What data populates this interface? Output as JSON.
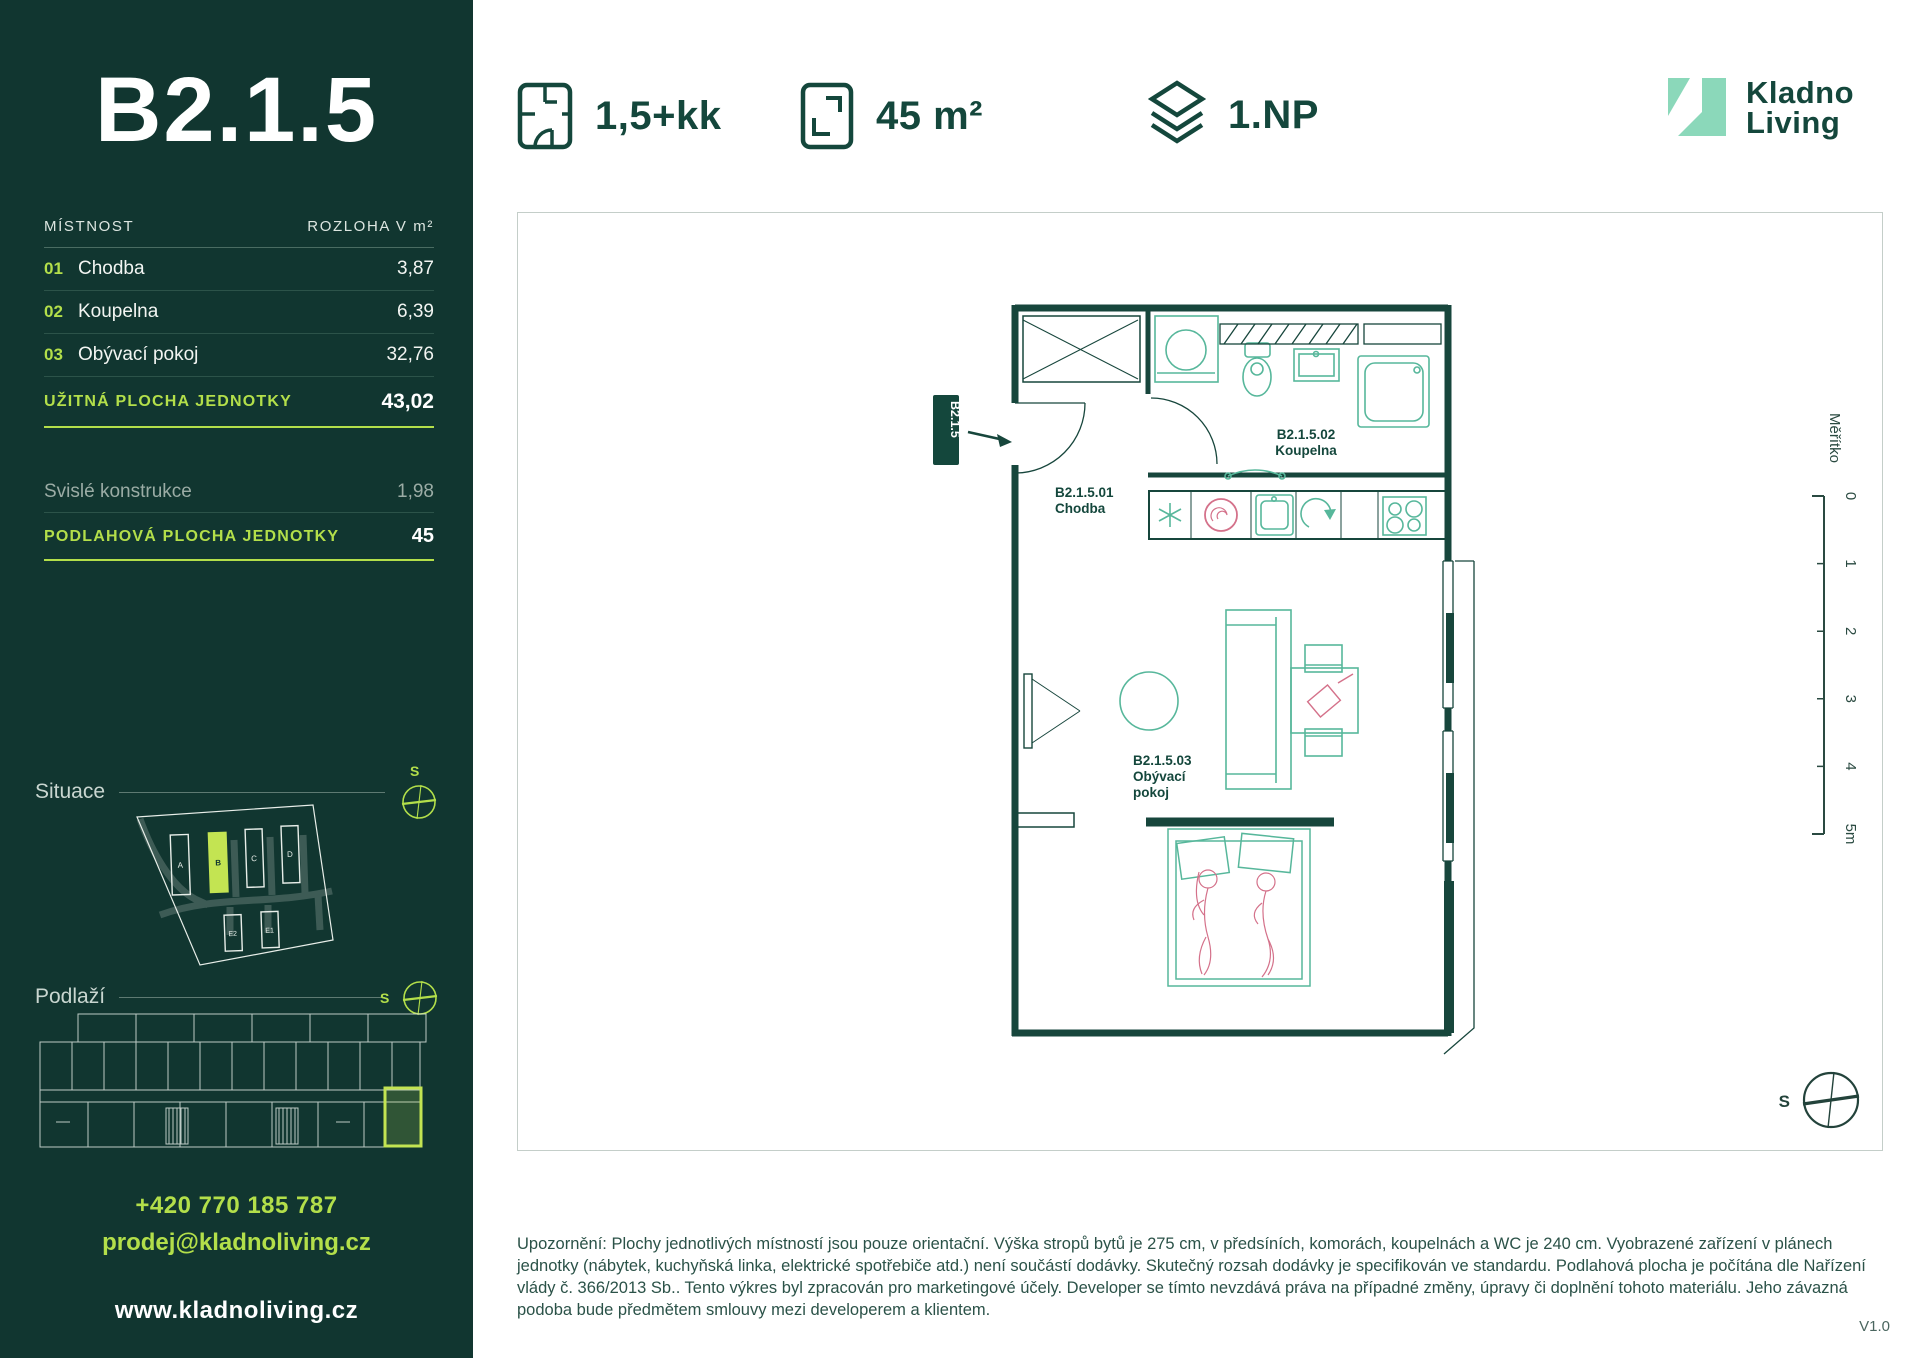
{
  "sidebar": {
    "unit_id": "B2.1.5",
    "table": {
      "header_room": "MÍSTNOST",
      "header_area": "ROZLOHA V m²",
      "rows": [
        {
          "num": "01",
          "name": "Chodba",
          "area": "3,87"
        },
        {
          "num": "02",
          "name": "Koupelna",
          "area": "6,39"
        },
        {
          "num": "03",
          "name": "Obývací pokoj",
          "area": "32,76"
        }
      ],
      "usable_label": "UŽITNÁ PLOCHA JEDNOTKY",
      "usable_value": "43,02",
      "construction_label": "Svislé konstrukce",
      "construction_value": "1,98",
      "floor_label": "PODLAHOVÁ PLOCHA JEDNOTKY",
      "floor_value": "45"
    },
    "situace_label": "Situace",
    "podlazi_label": "Podlaží",
    "compass_letter": "S",
    "site_buildings": [
      "A",
      "B",
      "C",
      "D",
      "E2",
      "E1"
    ],
    "highlighted_building": "B",
    "contact": {
      "phone": "+420 770 185 787",
      "email": "prodej@kladnoliving.cz",
      "web": "www.kladnoliving.cz"
    }
  },
  "header": {
    "specs": [
      {
        "label": "1,5+kk"
      },
      {
        "label": "45 m²"
      },
      {
        "label": "1.NP"
      }
    ],
    "logo_line1": "Kladno",
    "logo_line2": "Living"
  },
  "plan": {
    "entry_tag": "B2.1.5",
    "room1_id": "B2.1.5.01",
    "room1_name": "Chodba",
    "room2_id": "B2.1.5.02",
    "room2_name": "Koupelna",
    "room3_id": "B2.1.5.03",
    "room3_line1": "Obývací",
    "room3_line2": "pokoj",
    "scale_label": "Měřítko",
    "scale_ticks": [
      "0",
      "1",
      "2",
      "3",
      "4",
      "5m"
    ],
    "compass_letter": "S"
  },
  "footer": {
    "disclaimer": "Upozornění: Plochy jednotlivých místností jsou pouze orientační. Výška stropů bytů je 275 cm, v předsíních, komorách, koupelnách a WC je 240 cm. Vyobrazené zařízení v plánech jednotky (nábytek, kuchyňská linka, elektrické spotřebiče atd.) není součástí dodávky. Skutečný rozsah dodávky je specifikován ve standardu. Podlahová plocha je počítána dle Nařízení vlády č. 366/2013 Sb.. Tento výkres byl zpracován pro marketingové účely. Developer se tímto nevzdává práva na případné změny, úpravy či doplnění tohoto materiálu. Jeho závazná podoba bude předmětem smlouvy mezi developerem a klientem.",
    "version": "V1.0"
  },
  "colors": {
    "sidebar_bg": "#113630",
    "accent": "#B3DF4A",
    "dark_green": "#14473C",
    "mint": "#57B79B",
    "pink": "#D4718A"
  }
}
